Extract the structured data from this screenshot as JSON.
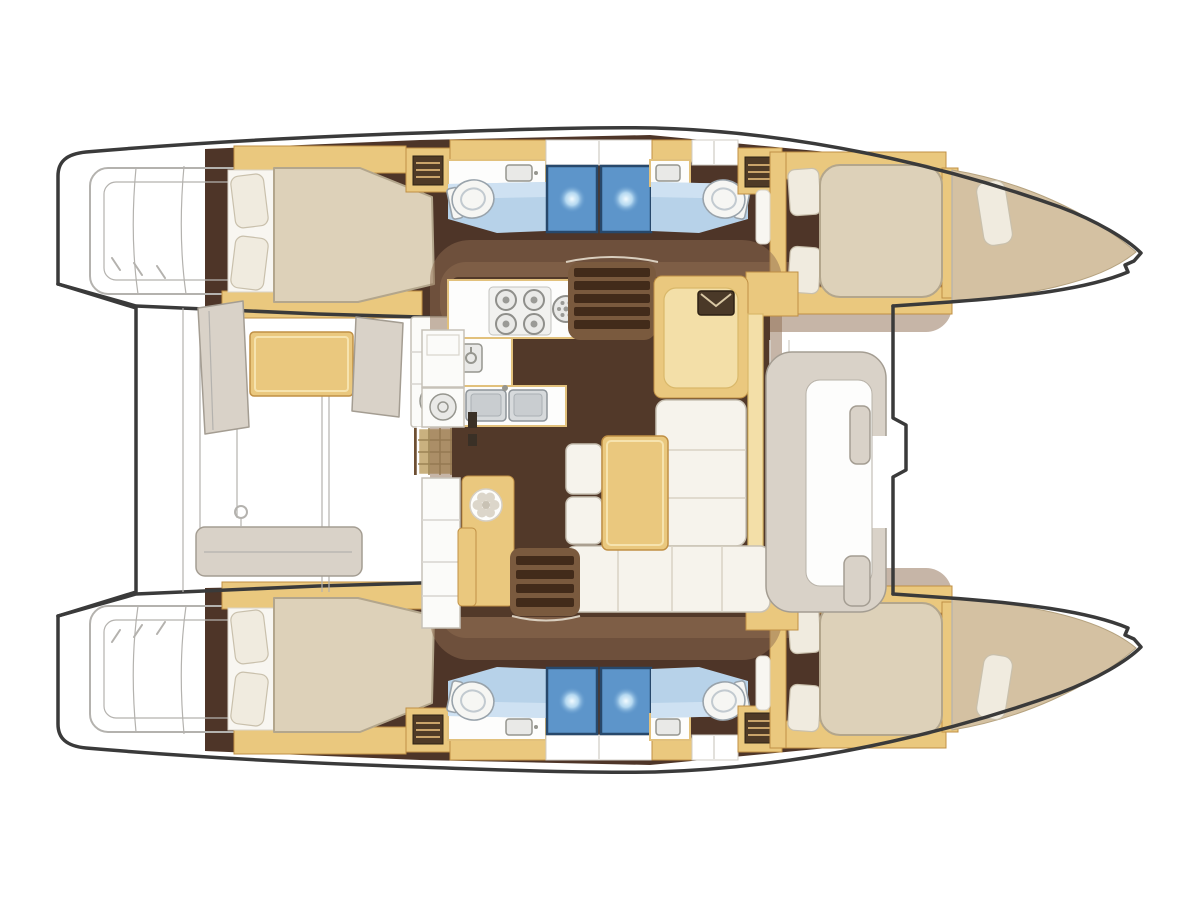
{
  "meta": {
    "title": "Catamaran deck plan",
    "subtitle": "Top-down interior layout diagram of a sailing catamaran",
    "image_type": "boat floor plan, no visible text"
  },
  "colors": {
    "outline": "#3a3a3a",
    "line": "#b4b2ae",
    "hull_floor": "#4e3528",
    "saloon_floor": "#523929",
    "wash": "#8d6c4f",
    "wood": "#eac87e",
    "wood_light": "#f3dfa8",
    "wood_stroke": "#c09045",
    "bed": "#ddd1b9",
    "bed_stroke": "#b3a68c",
    "pillow": "#f0ebdf",
    "pillow_stroke": "#c9c0ac",
    "bath": "#b7d2e9",
    "bath_light": "#d6e6f4",
    "shower": "#5d95ca",
    "shower_dark": "#27486b",
    "greige": "#d9d2c8",
    "greige_stroke": "#a49d92",
    "tan_bow": "#d4c1a2",
    "tan_bow_stroke": "#b5a27f",
    "steps_dark": "#422b1a",
    "steps_bg": "#7a5a3e",
    "rattan": "#c9b17f",
    "rattan_line": "#9c8455",
    "metal": "#e9e9e7",
    "metal_stroke": "#96968f",
    "counter_stroke": "#e2c17c",
    "hatch_dark": "#4f3a26",
    "hatch_line": "#c9a36a"
  },
  "regions": {
    "areas": [
      "port hull",
      "starboard hull",
      "aft cockpit",
      "saloon",
      "galley",
      "forward cockpit",
      "aft cabin with double berth (x2)",
      "forward cabin with double berth (x2)",
      "head with toilet and basin (x4)",
      "shower stall (x4)",
      "bow storage locker (x2)",
      "transom steps (x2)",
      "navigation station",
      "companionway stairs (x2)",
      "cockpit table",
      "saloon table",
      "stern crossbeam",
      "foredeck"
    ],
    "counts": {
      "double_berths": 4,
      "toilets": 4,
      "shower_stalls": 4,
      "hull_deck_hatches": 4
    }
  }
}
